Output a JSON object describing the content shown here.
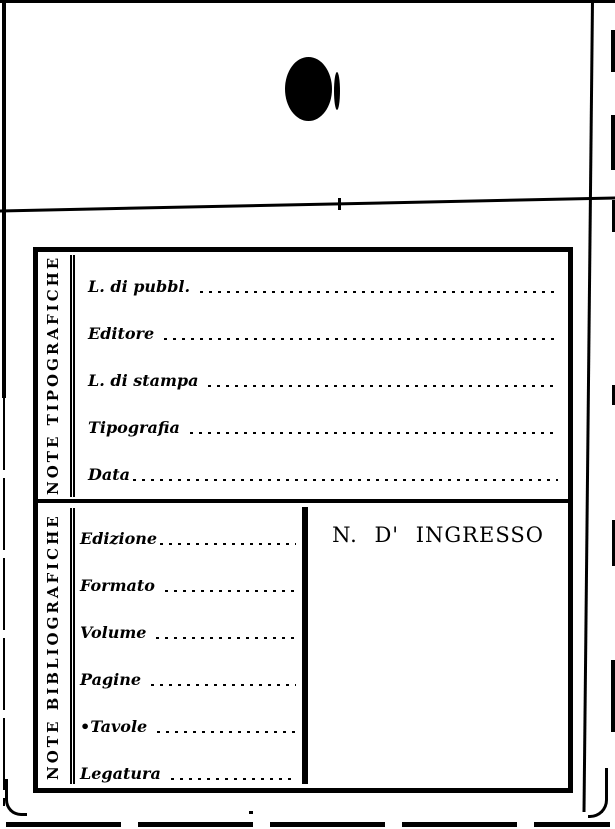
{
  "card": {
    "paper_color": "#ffffff",
    "ink_color": "#000000",
    "punch_hole": "black-punch-hole-mark",
    "typographic_section": {
      "side_label": "NOTE TIPOGRAFICHE",
      "fields": [
        {
          "label": "L. di pubbl.",
          "value": ""
        },
        {
          "label": "Editore",
          "value": ""
        },
        {
          "label": "L. di stampa",
          "value": ""
        },
        {
          "label": "Tipografia",
          "value": ""
        },
        {
          "label": "Data",
          "value": ""
        }
      ]
    },
    "bibliographic_section": {
      "side_label": "NOTE BIBLIOGRAFICHE",
      "fields": [
        {
          "label": "Edizione",
          "value": ""
        },
        {
          "label": "Formato",
          "value": ""
        },
        {
          "label": "Volume",
          "value": ""
        },
        {
          "label": "Pagine",
          "value": ""
        },
        {
          "label": "•Tavole",
          "value": ""
        },
        {
          "label": "Legatura",
          "value": ""
        }
      ],
      "ingresso_title": "N. D' INGRESSO"
    }
  }
}
